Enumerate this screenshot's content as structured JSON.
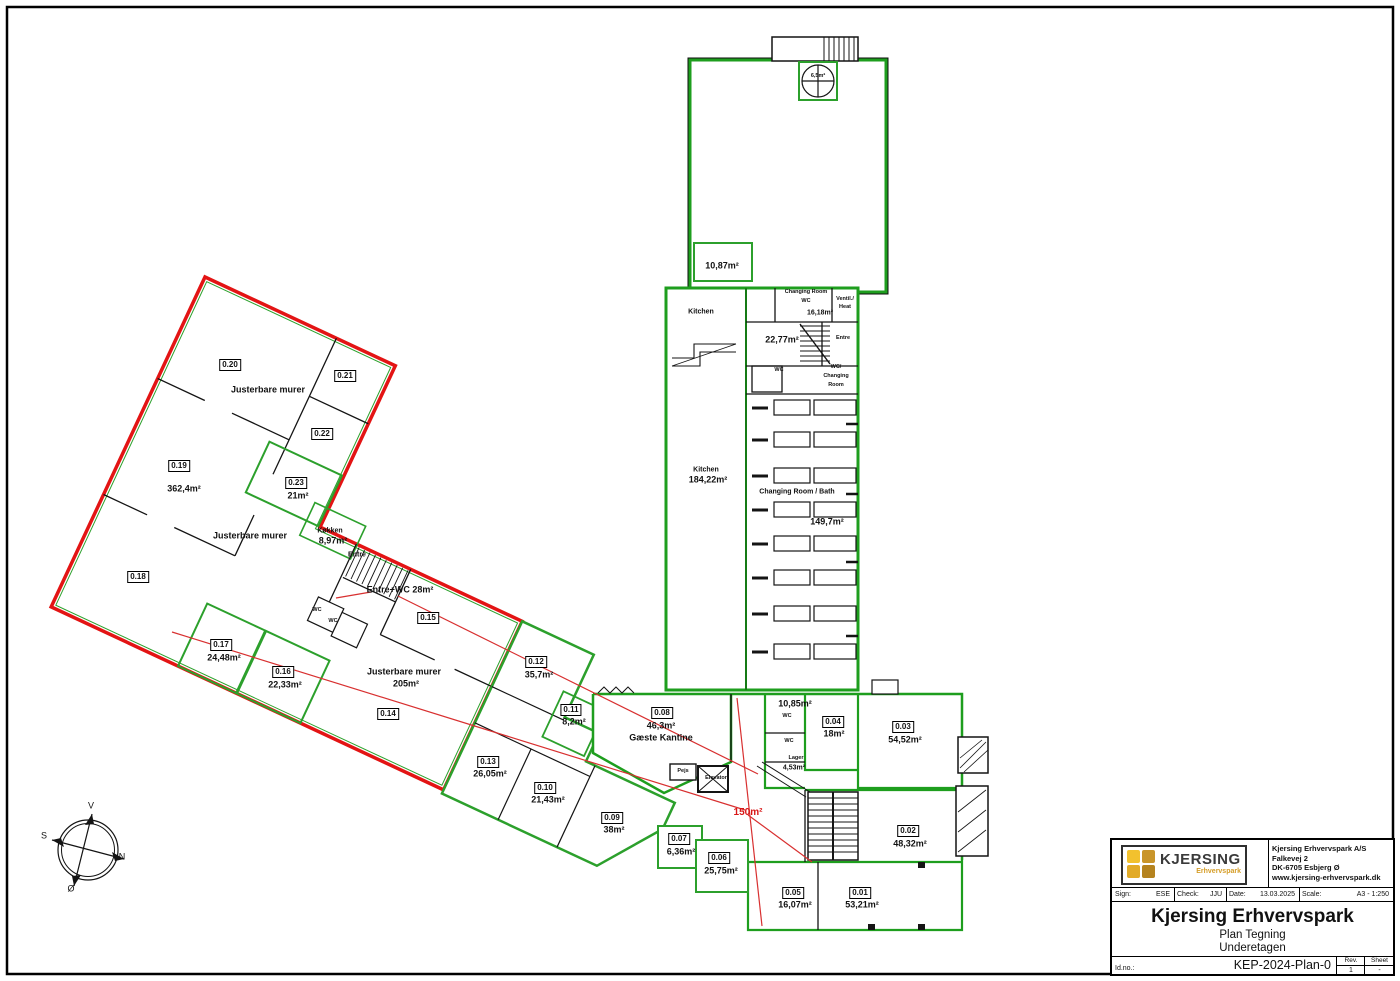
{
  "document": {
    "type": "architectural floor plan sheet",
    "sheet_border": true
  },
  "title_block": {
    "logo_text": "KJERSING",
    "logo_sub": "Erhvervspark",
    "logo_colors": [
      "#f2c12e",
      "#c9952a",
      "#e2ab28",
      "#b5831f"
    ],
    "company": "Kjersing Erhvervspark A/S",
    "address1": "Falkevej 2",
    "address2": "DK-6705 Esbjerg Ø",
    "website": "www.kjersing-erhvervspark.dk",
    "sign_label": "Sign:",
    "sign": "ESE",
    "check_label": "Check:",
    "check": "JJU",
    "date_label": "Date:",
    "date": "13.03.2025",
    "scale_label": "Scale:",
    "scale": "A3 - 1:250",
    "title": "Kjersing Erhvervspark",
    "subtitle1": "Plan Tegning",
    "subtitle2": "Underetagen",
    "idno_label": "Id.no.:",
    "idno": "KEP-2024-Plan-0",
    "rev_label": "Rev.",
    "rev": "1",
    "sheet_label": "Sheet",
    "sheet": "-"
  },
  "colors": {
    "wall_green": "#1e9e1e",
    "demise_red": "#e31414",
    "zone_red": "#d81616",
    "line_black": "#141414"
  },
  "compass": {
    "west": "V",
    "south": "S",
    "north": "N",
    "east": "Ø"
  },
  "plan": {
    "texts": [
      {
        "n": "room-0-20",
        "t": "0.20",
        "x": 230,
        "y": 365,
        "s": "box"
      },
      {
        "n": "room-0-21",
        "t": "0.21",
        "x": 345,
        "y": 376,
        "s": "box"
      },
      {
        "n": "room-0-22",
        "t": "0.22",
        "x": 322,
        "y": 434,
        "s": "box"
      },
      {
        "n": "room-0-23",
        "t": "0.23",
        "x": 296,
        "y": 483,
        "s": "box"
      },
      {
        "n": "room-0-23-area",
        "t": "21m²",
        "x": 298,
        "y": 496,
        "s": "area"
      },
      {
        "n": "room-0-19",
        "t": "0.19",
        "x": 179,
        "y": 466,
        "s": "box"
      },
      {
        "n": "room-0-19-area",
        "t": "362,4m²",
        "x": 184,
        "y": 489,
        "s": "area"
      },
      {
        "n": "room-0-18",
        "t": "0.18",
        "x": 138,
        "y": 577,
        "s": "box"
      },
      {
        "n": "room-0-17",
        "t": "0.17",
        "x": 221,
        "y": 645,
        "s": "box"
      },
      {
        "n": "room-0-17-area",
        "t": "24,48m²",
        "x": 224,
        "y": 658,
        "s": "area"
      },
      {
        "n": "room-0-16",
        "t": "0.16",
        "x": 283,
        "y": 672,
        "s": "box"
      },
      {
        "n": "room-0-16-area",
        "t": "22,33m²",
        "x": 285,
        "y": 685,
        "s": "area"
      },
      {
        "n": "room-0-15",
        "t": "0.15",
        "x": 428,
        "y": 618,
        "s": "box"
      },
      {
        "n": "room-0-14",
        "t": "0.14",
        "x": 388,
        "y": 714,
        "s": "box"
      },
      {
        "n": "room-0-13",
        "t": "0.13",
        "x": 488,
        "y": 762,
        "s": "box"
      },
      {
        "n": "room-0-13-area",
        "t": "26,05m²",
        "x": 490,
        "y": 774,
        "s": "area"
      },
      {
        "n": "room-0-12",
        "t": "0.12",
        "x": 536,
        "y": 662,
        "s": "box"
      },
      {
        "n": "room-0-12-area",
        "t": "35,7m²",
        "x": 539,
        "y": 675,
        "s": "area"
      },
      {
        "n": "room-0-11",
        "t": "0.11",
        "x": 571,
        "y": 710,
        "s": "box"
      },
      {
        "n": "room-0-11-area",
        "t": "8,2m²",
        "x": 574,
        "y": 722,
        "s": "area"
      },
      {
        "n": "room-0-10",
        "t": "0.10",
        "x": 545,
        "y": 788,
        "s": "box"
      },
      {
        "n": "room-0-10-area",
        "t": "21,43m²",
        "x": 548,
        "y": 800,
        "s": "area"
      },
      {
        "n": "room-0-09",
        "t": "0.09",
        "x": 612,
        "y": 818,
        "s": "box"
      },
      {
        "n": "room-0-09-area",
        "t": "38m²",
        "x": 614,
        "y": 830,
        "s": "area"
      },
      {
        "n": "room-0-08",
        "t": "0.08",
        "x": 662,
        "y": 713,
        "s": "box"
      },
      {
        "n": "room-0-08-area",
        "t": "46,3m²",
        "x": 661,
        "y": 726,
        "s": "area"
      },
      {
        "n": "room-0-08-name",
        "t": "Gæste Kantine",
        "x": 661,
        "y": 738,
        "s": "area"
      },
      {
        "n": "room-0-07",
        "t": "0.07",
        "x": 679,
        "y": 839,
        "s": "box"
      },
      {
        "n": "room-0-07-area",
        "t": "6,36m²",
        "x": 681,
        "y": 852,
        "s": "area"
      },
      {
        "n": "room-0-06",
        "t": "0.06",
        "x": 719,
        "y": 858,
        "s": "box"
      },
      {
        "n": "room-0-06-area",
        "t": "25,75m²",
        "x": 721,
        "y": 871,
        "s": "area"
      },
      {
        "n": "room-0-05",
        "t": "0.05",
        "x": 793,
        "y": 893,
        "s": "box"
      },
      {
        "n": "room-0-05-area",
        "t": "16,07m²",
        "x": 795,
        "y": 905,
        "s": "area"
      },
      {
        "n": "room-0-04",
        "t": "0.04",
        "x": 833,
        "y": 722,
        "s": "box"
      },
      {
        "n": "room-0-04-area",
        "t": "18m²",
        "x": 834,
        "y": 734,
        "s": "area"
      },
      {
        "n": "room-0-03",
        "t": "0.03",
        "x": 903,
        "y": 727,
        "s": "box"
      },
      {
        "n": "room-0-03-area",
        "t": "54,52m²",
        "x": 905,
        "y": 740,
        "s": "area"
      },
      {
        "n": "room-0-02",
        "t": "0.02",
        "x": 908,
        "y": 831,
        "s": "box"
      },
      {
        "n": "room-0-02-area",
        "t": "48,32m²",
        "x": 910,
        "y": 844,
        "s": "area"
      },
      {
        "n": "room-0-01",
        "t": "0.01",
        "x": 860,
        "y": 893,
        "s": "box"
      },
      {
        "n": "room-0-01-area",
        "t": "53,21m²",
        "x": 862,
        "y": 905,
        "s": "area"
      },
      {
        "n": "note-justerbare-1",
        "t": "Justerbare murer",
        "x": 268,
        "y": 390,
        "s": "area"
      },
      {
        "n": "note-justerbare-2",
        "t": "Justerbare murer",
        "x": 250,
        "y": 536,
        "s": "area"
      },
      {
        "n": "note-justerbare-3",
        "t": "Justerbare murer",
        "x": 404,
        "y": 672,
        "s": "area"
      },
      {
        "n": "note-justerbare-3-area",
        "t": "205m²",
        "x": 406,
        "y": 684,
        "s": "area"
      },
      {
        "n": "room-koekken",
        "t": "Køkken",
        "x": 330,
        "y": 531,
        "s": "small"
      },
      {
        "n": "room-koekken-area",
        "t": "8,97m²",
        "x": 333,
        "y": 541,
        "s": "area"
      },
      {
        "n": "room-entre-head",
        "t": "Entre",
        "x": 357,
        "y": 555,
        "s": "small"
      },
      {
        "n": "note-entre-wc",
        "t": "Entre+WC  28m²",
        "x": 400,
        "y": 590,
        "s": "area"
      },
      {
        "n": "room-wc-a",
        "t": "WC",
        "x": 317,
        "y": 611,
        "s": "tiny"
      },
      {
        "n": "room-wc-b",
        "t": "WC",
        "x": 333,
        "y": 622,
        "s": "tiny"
      },
      {
        "n": "room-kitchen-top",
        "t": "Kitchen",
        "x": 701,
        "y": 312,
        "s": "small"
      },
      {
        "n": "room-kitchen",
        "t": "Kitchen",
        "x": 706,
        "y": 470,
        "s": "small"
      },
      {
        "n": "room-kitchen-area",
        "t": "184,22m²",
        "x": 708,
        "y": 480,
        "s": "area"
      },
      {
        "n": "room-2277-area",
        "t": "22,77m²",
        "x": 782,
        "y": 340,
        "s": "area"
      },
      {
        "n": "room-entre-mid",
        "t": "Entre",
        "x": 843,
        "y": 339,
        "s": "tiny"
      },
      {
        "n": "room-changing-top-1",
        "t": "Changing Room",
        "x": 806,
        "y": 293,
        "s": "tiny"
      },
      {
        "n": "room-changing-top-2",
        "t": "WC",
        "x": 806,
        "y": 302,
        "s": "tiny"
      },
      {
        "n": "room-1618-area",
        "t": "16,18m²",
        "x": 820,
        "y": 313,
        "s": "small"
      },
      {
        "n": "room-ventil-1",
        "t": "Ventil./",
        "x": 845,
        "y": 300,
        "s": "tiny"
      },
      {
        "n": "room-ventil-2",
        "t": "Heat",
        "x": 845,
        "y": 308,
        "s": "tiny"
      },
      {
        "n": "room-wc-mid",
        "t": "WC",
        "x": 779,
        "y": 371,
        "s": "tiny"
      },
      {
        "n": "room-wc-changing-1",
        "t": "WC/",
        "x": 836,
        "y": 368,
        "s": "tiny"
      },
      {
        "n": "room-wc-changing-2",
        "t": "Changing",
        "x": 836,
        "y": 377,
        "s": "tiny"
      },
      {
        "n": "room-wc-changing-3",
        "t": "Room",
        "x": 836,
        "y": 386,
        "s": "tiny"
      },
      {
        "n": "room-changing-bath",
        "t": "Changing Room / Bath",
        "x": 797,
        "y": 492,
        "s": "small"
      },
      {
        "n": "room-changing-bath-area",
        "t": "149,7m²",
        "x": 827,
        "y": 522,
        "s": "area"
      },
      {
        "n": "room-1087-area",
        "t": "10,87m²",
        "x": 722,
        "y": 266,
        "s": "area"
      },
      {
        "n": "room-65-area",
        "t": "6,5m²",
        "x": 818,
        "y": 77,
        "s": "tiny"
      },
      {
        "n": "room-1085-area",
        "t": "10,85m²",
        "x": 795,
        "y": 704,
        "s": "area"
      },
      {
        "n": "room-wc-c",
        "t": "WC",
        "x": 787,
        "y": 717,
        "s": "tiny"
      },
      {
        "n": "room-wc-d",
        "t": "WC",
        "x": 789,
        "y": 742,
        "s": "tiny"
      },
      {
        "n": "room-lager",
        "t": "Lager",
        "x": 796,
        "y": 759,
        "s": "tiny"
      },
      {
        "n": "room-lager-area",
        "t": "4,53m²",
        "x": 794,
        "y": 768,
        "s": "small"
      },
      {
        "n": "room-pejs",
        "t": "Pejs",
        "x": 683,
        "y": 772,
        "s": "tiny"
      },
      {
        "n": "room-elevator",
        "t": "Elevator",
        "x": 716,
        "y": 779,
        "s": "tiny"
      },
      {
        "n": "zone-150-area",
        "t": "150m²",
        "x": 748,
        "y": 813,
        "s": "red"
      },
      {
        "n": "compass-west",
        "t": "V",
        "x": 91,
        "y": 806,
        "s": "comp"
      },
      {
        "n": "compass-south",
        "t": "S",
        "x": 44,
        "y": 836,
        "s": "comp"
      },
      {
        "n": "compass-north",
        "t": "N",
        "x": 122,
        "y": 857,
        "s": "comp"
      },
      {
        "n": "compass-east",
        "t": "Ø",
        "x": 71,
        "y": 889,
        "s": "comp"
      }
    ]
  }
}
